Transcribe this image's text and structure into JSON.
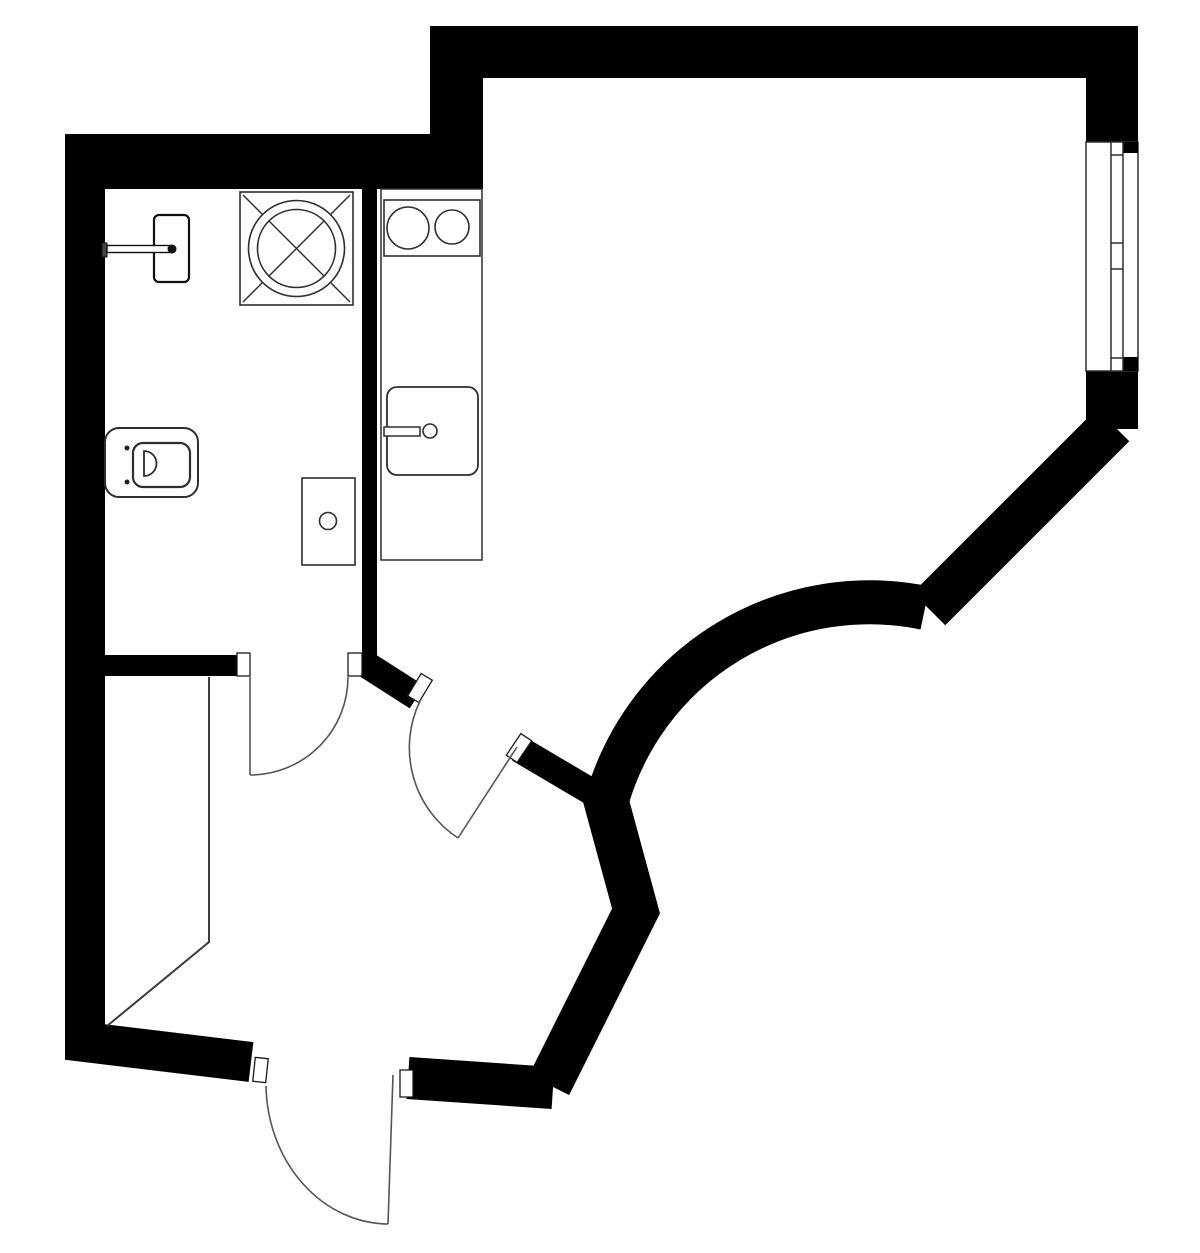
{
  "canvas": {
    "w": 1200,
    "h": 1253
  },
  "colors": {
    "background": "#ffffff",
    "wall": "#000000",
    "fixture_outline": "#2e2e2e",
    "door_line": "#555555",
    "hall_line": "#3c3c3c",
    "jamb_fill": "#ffffff",
    "jamb_stroke": "#1a1a1a"
  },
  "plan": {
    "wall_rects": [
      {
        "name": "wall-top-bathroom",
        "x": 65,
        "y": 134,
        "w": 418,
        "h": 55
      },
      {
        "name": "wall-jog",
        "x": 430,
        "y": 26,
        "w": 53,
        "h": 163
      },
      {
        "name": "wall-top-main",
        "x": 430,
        "y": 26,
        "w": 708,
        "h": 52
      },
      {
        "name": "wall-right-upper",
        "x": 1086,
        "y": 26,
        "w": 52,
        "h": 116
      },
      {
        "name": "wall-right-lower",
        "x": 1086,
        "y": 371,
        "w": 52,
        "h": 58
      },
      {
        "name": "wall-bathroom-bottom",
        "x": 105,
        "y": 655,
        "w": 132,
        "h": 21
      },
      {
        "name": "wall-divider-kitchen",
        "x": 362,
        "y": 189,
        "w": 15,
        "h": 488
      }
    ],
    "wall_strokes": [
      {
        "name": "wall-left",
        "points": [
          [
            85,
            136
          ],
          [
            85,
            1042
          ],
          [
            251,
            1062
          ]
        ],
        "width": 40
      },
      {
        "name": "wall-right-diagonal",
        "points": [
          [
            1113,
            425
          ],
          [
            929,
            609
          ]
        ],
        "width": 46
      },
      {
        "name": "wall-stub-upper",
        "points": [
          [
            367,
            665
          ],
          [
            417,
            697
          ]
        ],
        "width": 27
      },
      {
        "name": "wall-stub-lower",
        "points": [
          [
            519,
            749
          ],
          [
            607,
            801
          ]
        ],
        "width": 27
      },
      {
        "name": "wall-zigzag",
        "points": [
          [
            605,
            797
          ],
          [
            636,
            911
          ],
          [
            549,
            1085
          ]
        ],
        "width": 45
      },
      {
        "name": "wall-bottom-right",
        "points": [
          [
            408,
            1078
          ],
          [
            553,
            1088
          ]
        ],
        "width": 42
      }
    ],
    "wall_arc": {
      "name": "wall-curved",
      "path": "M607,800 A273,273 0 0 1 925,608",
      "width": 44
    },
    "window": {
      "opening": {
        "x": 1086,
        "y": 142,
        "w": 52,
        "h": 229
      },
      "sash": {
        "x": 1111,
        "y": 142,
        "w": 12,
        "h": 229
      },
      "tick_ys": [
        155,
        243,
        269,
        358
      ],
      "corner_blocks": [
        {
          "x": 1123,
          "y": 142,
          "w": 15,
          "h": 11
        },
        {
          "x": 1123,
          "y": 357,
          "w": 15,
          "h": 14
        }
      ]
    },
    "jambs": [
      {
        "name": "jamb-bath-left",
        "cx": 243.5,
        "cy": 664.5,
        "w": 13,
        "h": 23,
        "a": 0
      },
      {
        "name": "jamb-bath-right",
        "cx": 355,
        "cy": 664.5,
        "w": 14,
        "h": 23,
        "a": 0
      },
      {
        "name": "jamb-room-upper",
        "cx": 420,
        "cy": 688,
        "w": 13,
        "h": 26,
        "a": 31
      },
      {
        "name": "jamb-room-lower",
        "cx": 519,
        "cy": 748,
        "w": 13,
        "h": 26,
        "a": 34
      },
      {
        "name": "jamb-entry-left",
        "cx": 260.5,
        "cy": 1070,
        "w": 13,
        "h": 24,
        "a": 6
      },
      {
        "name": "jamb-entry-right",
        "cx": 406.5,
        "cy": 1083.5,
        "w": 13,
        "h": 27,
        "a": 0
      }
    ],
    "doors": [
      {
        "name": "door-bathroom",
        "leaf": [
          [
            250,
            677
          ],
          [
            250,
            775
          ]
        ],
        "arc": "M250,775 A98,98 0 0 0 348,677"
      },
      {
        "name": "door-room",
        "leaf": [
          [
            517,
            747
          ],
          [
            458,
            838
          ]
        ],
        "arc": "M420,701 A108,108 0 0 0 458,838"
      },
      {
        "name": "door-entry",
        "leaf": [
          [
            393,
            1075
          ],
          [
            388,
            1224
          ]
        ],
        "arc": "M266,1086 A123,141 0 0 0 388,1224"
      }
    ],
    "hall_lines": [
      {
        "name": "hall-niche-line",
        "points": [
          [
            209,
            677
          ],
          [
            209,
            942
          ],
          [
            107,
            1026
          ]
        ],
        "width": 2
      }
    ],
    "fixtures": {
      "shower": {
        "box": {
          "x": 240,
          "y": 192,
          "w": 113,
          "h": 113
        },
        "cx": 296.5,
        "cy": 248.5,
        "outer_r": 48,
        "inner_r": 39,
        "corner_ticks": [
          [
            [
              243,
              195
            ],
            [
              262,
              214
            ]
          ],
          [
            [
              350,
              195
            ],
            [
              331,
              214
            ]
          ],
          [
            [
              243,
              302
            ],
            [
              262,
              283
            ]
          ],
          [
            [
              350,
              302
            ],
            [
              331,
              283
            ]
          ]
        ],
        "cross": [
          [
            [
              269,
              221
            ],
            [
              324,
              276
            ]
          ],
          [
            [
              324,
              221
            ],
            [
              269,
              276
            ]
          ]
        ]
      },
      "towel_radiator": {
        "panel": {
          "x": 154,
          "y": 215,
          "w": 35,
          "h": 67,
          "rx": 5
        },
        "cap": {
          "x": 102,
          "y": 243,
          "w": 5,
          "h": 14
        },
        "bar": {
          "x": 107,
          "y": 245.5,
          "w": 65,
          "h": 7
        },
        "knob": {
          "cx": 172,
          "cy": 249,
          "r": 4.5
        }
      },
      "toilet": {
        "body": {
          "x": 105,
          "y": 428,
          "w": 93,
          "h": 69,
          "rx": 14
        },
        "bowl": {
          "x": 133,
          "y": 443,
          "w": 57,
          "h": 44,
          "rx": 10
        },
        "flush_path": "M144,451 L144,476 A12.5,12.5 0 0 0 144,451 Z",
        "bolts": [
          {
            "cx": 127,
            "cy": 448,
            "r": 2.5
          },
          {
            "cx": 127,
            "cy": 482,
            "r": 2.5
          }
        ]
      },
      "washer": {
        "box": {
          "x": 302,
          "y": 478,
          "w": 53,
          "h": 87
        },
        "knob": {
          "cx": 328,
          "cy": 521,
          "r": 8.5
        }
      },
      "counter": {
        "x": 381,
        "y": 189,
        "w": 101,
        "h": 371
      },
      "cooktop": {
        "box": {
          "x": 384,
          "y": 200,
          "w": 96,
          "h": 56
        },
        "burners": [
          {
            "cx": 408,
            "cy": 228,
            "r": 21
          },
          {
            "cx": 452,
            "cy": 227,
            "r": 17
          }
        ]
      },
      "sink": {
        "box": {
          "x": 387,
          "y": 387,
          "w": 91,
          "h": 88,
          "rx": 10
        },
        "tap_bar": {
          "x": 384,
          "y": 427,
          "w": 36,
          "h": 9
        },
        "tap_knob": {
          "cx": 430,
          "cy": 431,
          "r": 7
        }
      }
    }
  }
}
